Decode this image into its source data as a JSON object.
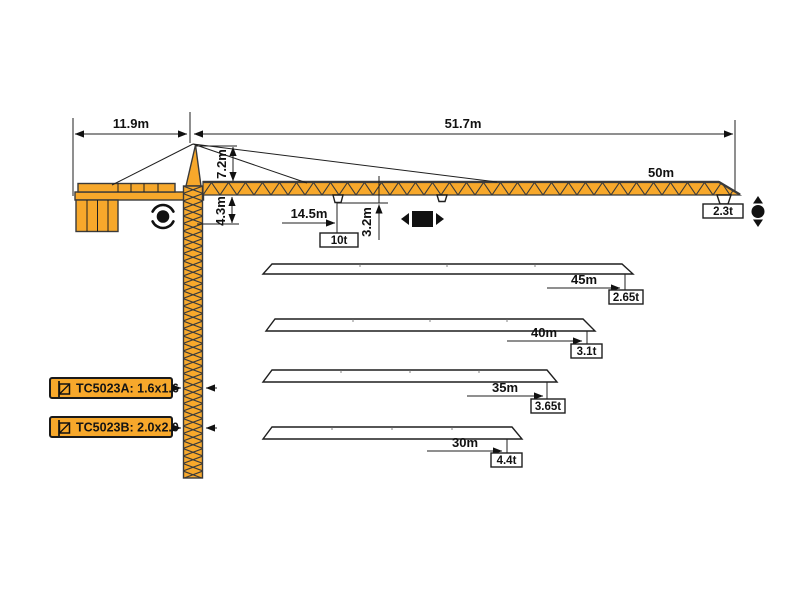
{
  "colors": {
    "crane_orange": "#F7A82B",
    "outline_dark": "#3A3A3A"
  },
  "top_dimensions": {
    "counter_jib": "11.9m",
    "jib_side": "51.7m"
  },
  "tower": {
    "head_height": "7.2m",
    "jib_to_slew": "4.3m"
  },
  "trolley": {
    "radius": "14.5m",
    "load": "10t",
    "hook_dim": "3.2m"
  },
  "main_jib": {
    "length": "50m",
    "tip_load": "2.3t"
  },
  "jib_variants": [
    {
      "length": "45m",
      "tip_load": "2.65t"
    },
    {
      "length": "40m",
      "tip_load": "3.1t"
    },
    {
      "length": "35m",
      "tip_load": "3.65t"
    },
    {
      "length": "30m",
      "tip_load": "4.4t"
    }
  ],
  "models": [
    {
      "label": "TC5023A: 1.6x1.6"
    },
    {
      "label": "TC5023B: 2.0x2.0"
    }
  ],
  "icons": {
    "slewing": "slewing-rotation-icon",
    "trolley": "trolley-travel-icon",
    "hoist": "hook-hoist-icon",
    "mast_section": "mast-section-icon"
  }
}
